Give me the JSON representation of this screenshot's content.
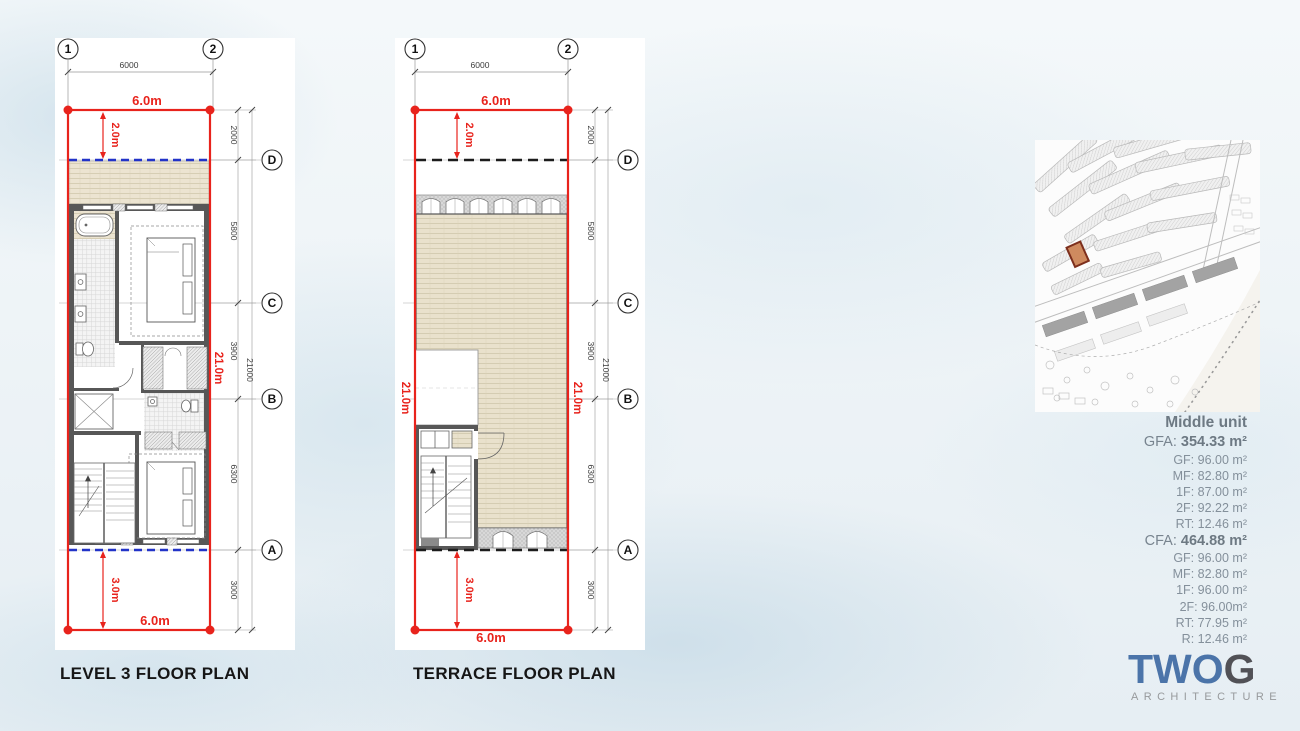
{
  "titles": {
    "plan1": "LEVEL 3 FLOOR PLAN",
    "plan2": "TERRACE FLOOR PLAN"
  },
  "plans": {
    "grid_cols": [
      "1",
      "2"
    ],
    "grid_rows": [
      "D",
      "C",
      "B",
      "A"
    ],
    "dim_width": "6000",
    "dim_segments": [
      "2000",
      "5800",
      "3900",
      "6300",
      "3000"
    ],
    "dim_total": "21000",
    "red_dims": {
      "width_top": "6.0m",
      "front_setback": "2.0m",
      "depth": "21.0m",
      "rear_setback": "3.0m",
      "width_bottom": "6.0m"
    }
  },
  "unit_stats": {
    "title": "Middle unit",
    "gfa_label": "GFA:",
    "gfa_value": "354.33 m²",
    "gfa_rows": [
      {
        "label": "GF:",
        "value": "96.00 m²"
      },
      {
        "label": "MF:",
        "value": "82.80 m²"
      },
      {
        "label": "1F:",
        "value": "87.00 m²"
      },
      {
        "label": "2F:",
        "value": "92.22 m²"
      },
      {
        "label": "RT:",
        "value": "12.46 m²"
      }
    ],
    "cfa_label": "CFA:",
    "cfa_value": "464.88 m²",
    "cfa_rows": [
      {
        "label": "GF:",
        "value": "96.00 m²"
      },
      {
        "label": "MF:",
        "value": "82.80 m²"
      },
      {
        "label": "1F:",
        "value": "96.00 m²"
      },
      {
        "label": "2F:",
        "value": "96.00m²"
      },
      {
        "label": "RT:",
        "value": "77.95 m²"
      },
      {
        "label": "R:",
        "value": "12.46 m²"
      }
    ]
  },
  "logo": {
    "word_blue": "TWO",
    "word_gray": "G",
    "subtitle": "ARCHITECTURE"
  },
  "colors": {
    "boundary_red": "#e8231c",
    "balcony_line_blue": "#2233c8",
    "highlight_lot": "#cf8a5f",
    "logo_blue": "#4b74a9",
    "logo_gray": "#515156"
  }
}
